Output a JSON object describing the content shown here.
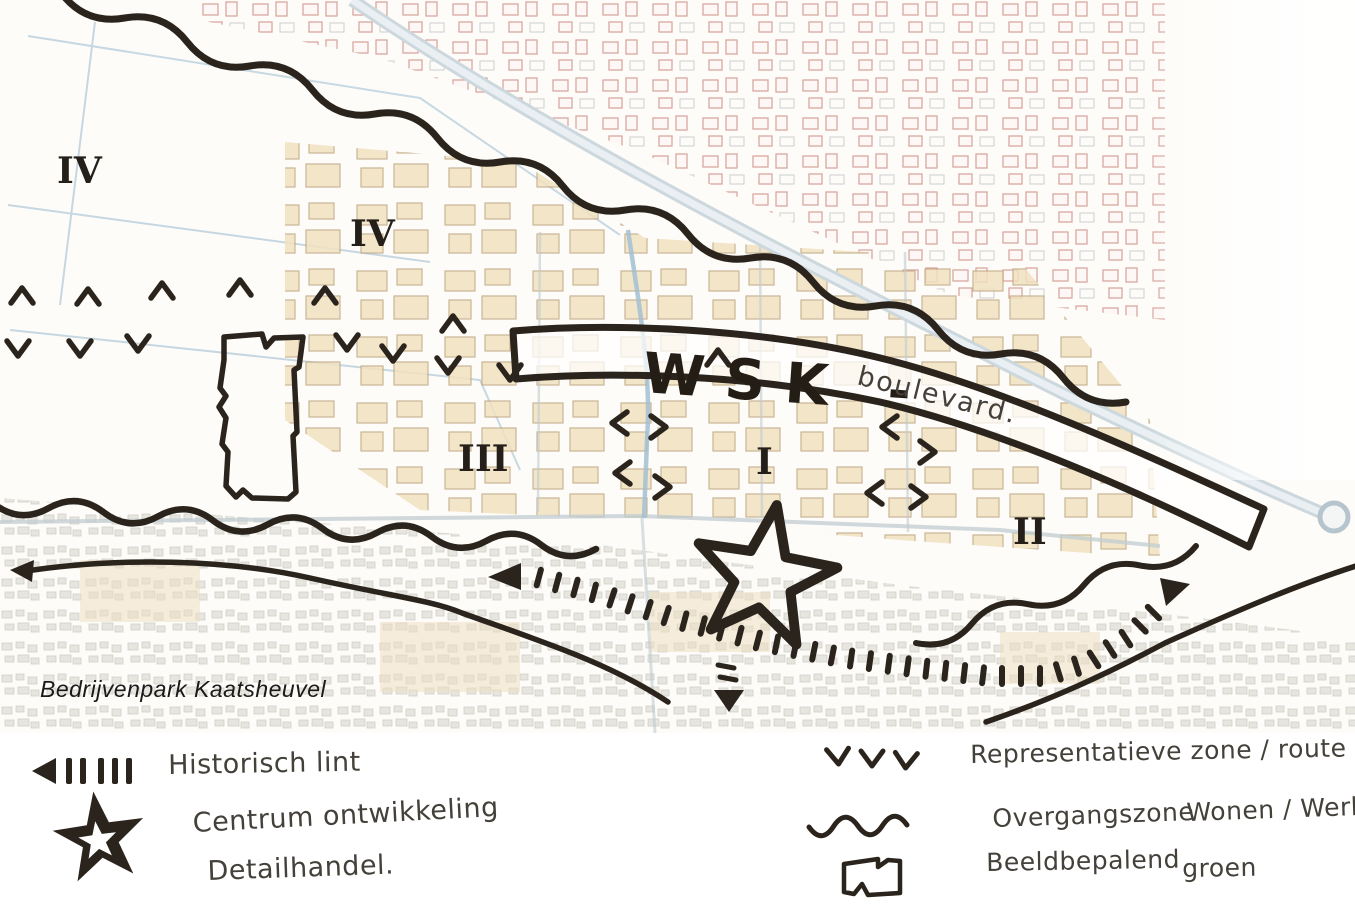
{
  "palette": {
    "ink": "#2b241d",
    "building_red": "#c9827c",
    "building_beige": "#f1e1bf",
    "residential_gray": "#d6d5cd",
    "road_blue": "#c0ccd2"
  },
  "map": {
    "title": "Bedrijvenpark Kaatsheuvel",
    "wsk_label": "WSK -",
    "wsk_sublabel": "boulevard.",
    "zone_labels": [
      {
        "text": "IV"
      },
      {
        "text": "IV"
      },
      {
        "text": "III"
      },
      {
        "text": "I"
      },
      {
        "text": "II"
      }
    ],
    "chevrons": [
      {
        "x": 22,
        "y": 296,
        "rot": 180
      },
      {
        "x": 88,
        "y": 297,
        "rot": 180
      },
      {
        "x": 162,
        "y": 291,
        "rot": 180
      },
      {
        "x": 240,
        "y": 288,
        "rot": 180
      },
      {
        "x": 325,
        "y": 296,
        "rot": 180
      },
      {
        "x": 453,
        "y": 324,
        "rot": 180
      },
      {
        "x": 718,
        "y": 358,
        "rot": 180
      },
      {
        "x": 18,
        "y": 348,
        "rot": 0
      },
      {
        "x": 80,
        "y": 348,
        "rot": 0
      },
      {
        "x": 138,
        "y": 343,
        "rot": 0
      },
      {
        "x": 347,
        "y": 342,
        "rot": 0
      },
      {
        "x": 393,
        "y": 353,
        "rot": 0
      },
      {
        "x": 448,
        "y": 365,
        "rot": 0
      },
      {
        "x": 510,
        "y": 372,
        "rot": 0
      },
      {
        "x": 620,
        "y": 423,
        "rot": 90
      },
      {
        "x": 658,
        "y": 427,
        "rot": -90
      },
      {
        "x": 623,
        "y": 473,
        "rot": 90
      },
      {
        "x": 662,
        "y": 487,
        "rot": -90
      },
      {
        "x": 890,
        "y": 427,
        "rot": 90
      },
      {
        "x": 927,
        "y": 452,
        "rot": -90
      },
      {
        "x": 875,
        "y": 493,
        "rot": 90
      },
      {
        "x": 918,
        "y": 497,
        "rot": -90
      }
    ]
  },
  "legend": {
    "items_left": [
      {
        "id": "historic-line",
        "label": "Historisch lint"
      },
      {
        "id": "centre-star",
        "label": "Centrum ontwikkeling",
        "label2": "Detailhandel."
      }
    ],
    "items_right": [
      {
        "id": "representative-zone",
        "label": "Representatieve zone / route"
      },
      {
        "id": "transition-zone",
        "label": "Overgangszone",
        "label2": "Wonen / Werken"
      },
      {
        "id": "defining-green",
        "label": "Beeldbepalend",
        "label2": "groen"
      }
    ]
  }
}
